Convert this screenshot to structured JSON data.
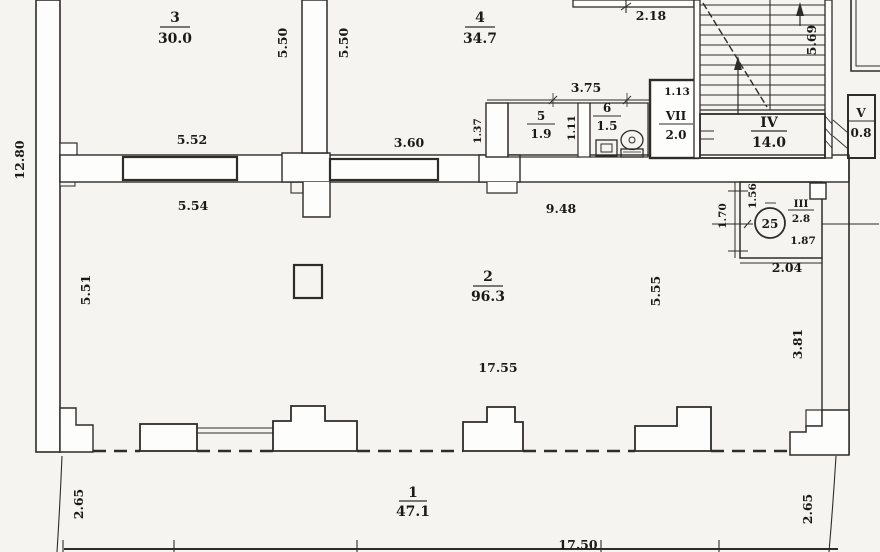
{
  "palette": {
    "paper": "#f5f4f1",
    "paper2": "#fdfdfb",
    "ink": "#2e2c29",
    "ink2": "#1b1a18"
  },
  "plan": {
    "type": "apartment-floor-plan",
    "rooms": {
      "room3": {
        "number": "3",
        "area": "30.0"
      },
      "room4": {
        "number": "4",
        "area": "34.7"
      },
      "room5": {
        "number": "5",
        "area": "1.9"
      },
      "room6": {
        "number": "6",
        "area": "1.5"
      },
      "roomVII": {
        "number": "VII",
        "area": "2.0"
      },
      "roomIV": {
        "number": "IV",
        "area": "14.0"
      },
      "roomV": {
        "number": "V",
        "area": "0.8"
      },
      "roomIII": {
        "number": "III",
        "area": "2.8"
      },
      "room2": {
        "number": "2",
        "area": "96.3"
      },
      "room1": {
        "number": "1",
        "area": "47.1"
      }
    },
    "entrance_marker": "25",
    "dims": {
      "h218": "2.18",
      "h552": "5.52",
      "h554": "5.54",
      "h360": "3.60",
      "h375": "3.75",
      "h113": "1.13",
      "h948": "9.48",
      "h187": "1.87",
      "h204": "2.04",
      "h1755": "17.55",
      "h1750": "17.50",
      "v1280": "12.80",
      "v550a": "5.50",
      "v550b": "5.50",
      "v569": "5.69",
      "v137": "1.37",
      "v111": "1.11",
      "v170": "1.70",
      "v156": "1.56",
      "v551": "5.51",
      "v555": "5.55",
      "v381": "3.81",
      "v265l": "2.65",
      "v265r": "2.65"
    }
  }
}
